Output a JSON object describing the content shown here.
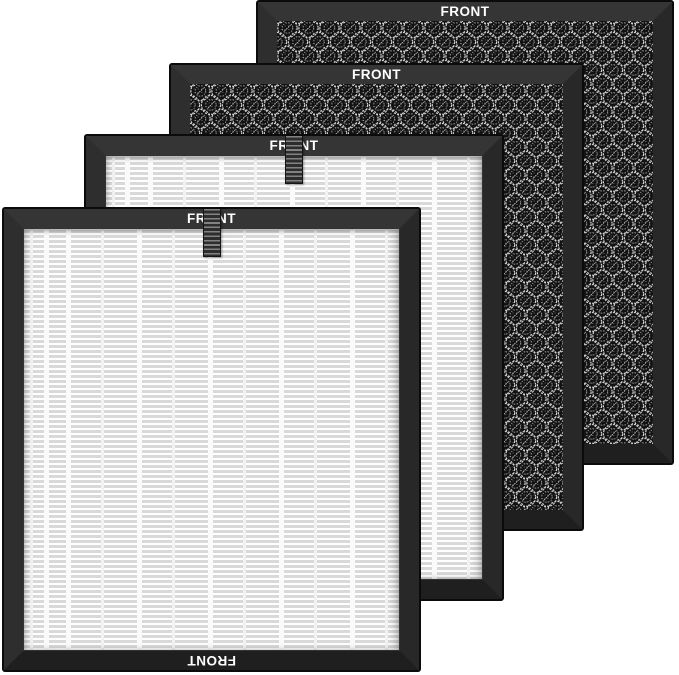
{
  "scene": {
    "type": "product-photo",
    "subject": "Four air purifier replacement filters fanned in an overlapping diagonal stack on a white background",
    "background_color": "#ffffff"
  },
  "filters": [
    {
      "name": "activated-carbon-filter-back",
      "media": "honeycomb-carbon",
      "front_label": "FRONT",
      "has_pull_tab": false
    },
    {
      "name": "activated-carbon-filter-middle",
      "media": "honeycomb-carbon",
      "front_label": "FRONT",
      "has_pull_tab": false
    },
    {
      "name": "hepa-filter-middle",
      "media": "pleated-hepa",
      "front_label": "FRONT",
      "has_pull_tab": true
    },
    {
      "name": "hepa-filter-front",
      "media": "pleated-hepa",
      "front_label": "FRONT",
      "front_label_bottom": "FRONT",
      "has_pull_tab": true
    }
  ],
  "colors": {
    "frame": "#2b2b2b",
    "frame_edge": "#0b0b0b",
    "carbon_background": "#121212",
    "carbon_mesh_ring": "#cfcfcf",
    "pleat_line": "#d9d9d9",
    "pleat_paper": "#fdfdfd",
    "label_text": "#ffffff",
    "tab_light": "#828282",
    "tab_dark": "#2d2d2d"
  }
}
